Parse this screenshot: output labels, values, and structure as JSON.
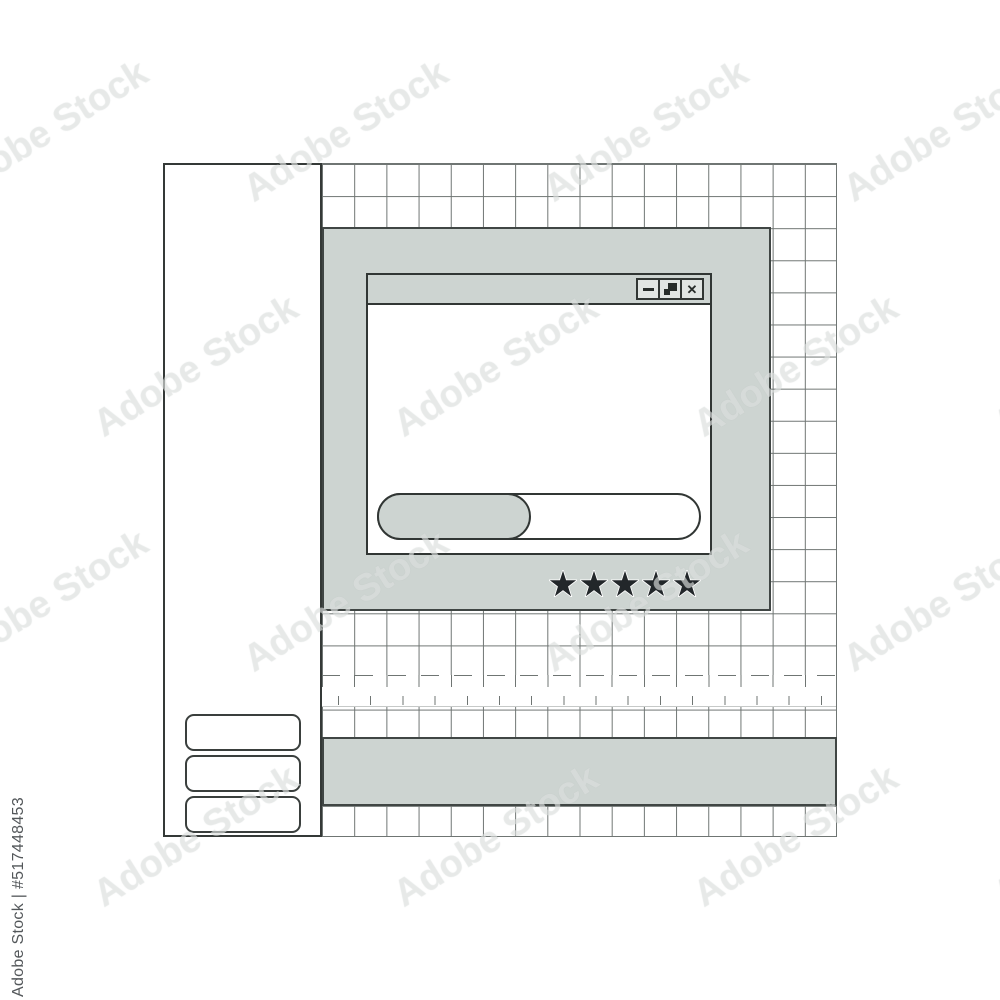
{
  "watermark": {
    "brand": "Adobe Stock",
    "credit": "Adobe Stock | #517448453",
    "tile_rows": 4,
    "tile_cols": 4
  },
  "palette": {
    "panel_gray": "#cdd4d1",
    "border_dark": "#313634",
    "grid_line": "#6f7573",
    "star_color": "#22272a",
    "button_face": "#e1e5e3"
  },
  "sidebar": {
    "slot_count": 3
  },
  "grid": {
    "columns": 16,
    "rows": 21
  },
  "window": {
    "buttons": [
      {
        "name": "minimize"
      },
      {
        "name": "restore"
      },
      {
        "name": "close",
        "glyph": "✕"
      }
    ],
    "progress_percent": 48
  },
  "rating": {
    "stars_filled": 5,
    "stars_total": 5
  }
}
